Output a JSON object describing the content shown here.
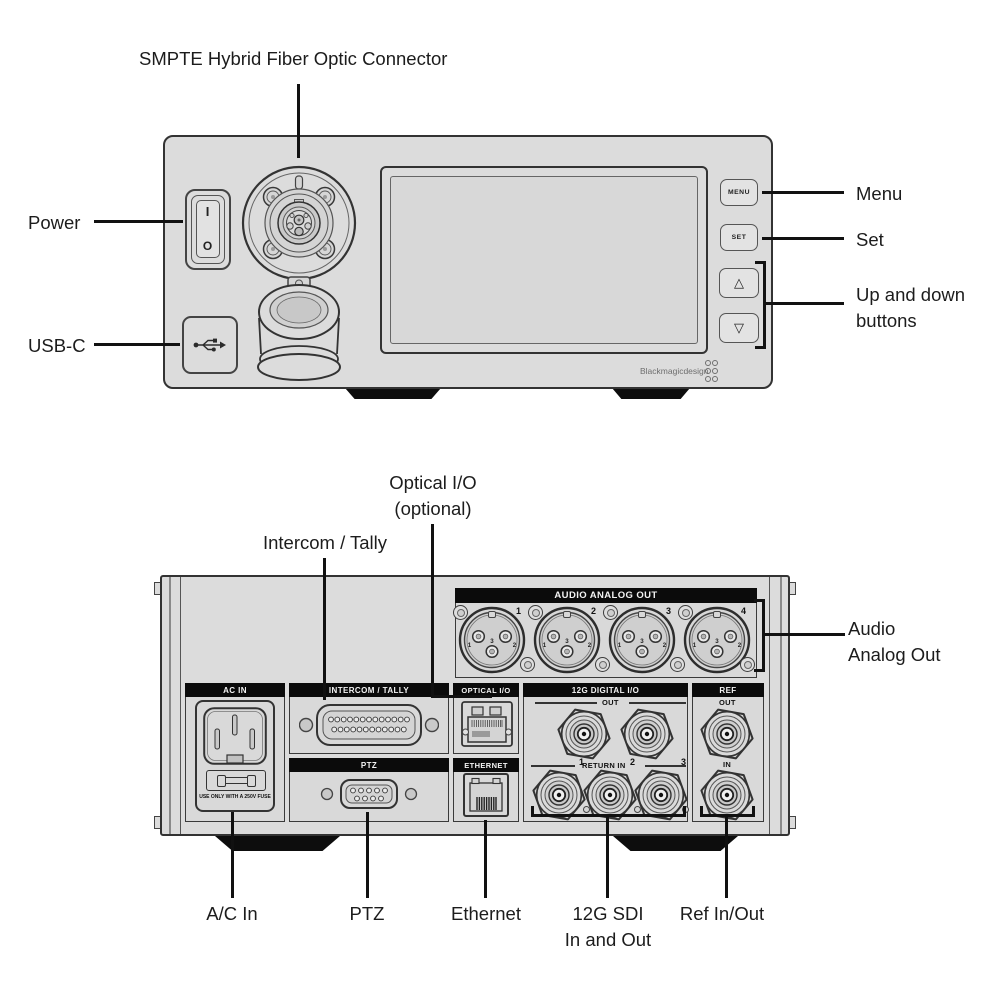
{
  "front": {
    "callout_smpte": "SMPTE Hybrid Fiber Optic Connector",
    "callout_power": "Power",
    "callout_usbc": "USB-C",
    "callout_menu": "Menu",
    "callout_set": "Set",
    "callout_updown": [
      "Up and down",
      "buttons"
    ],
    "btn_menu": "MENU",
    "btn_set": "SET",
    "btn_up": "△",
    "btn_down": "▽",
    "power_on": "I",
    "power_off": "O",
    "brand": "Blackmagicdesign"
  },
  "rear": {
    "callout_optical": [
      "Optical I/O",
      "(optional)"
    ],
    "callout_intercom": "Intercom / Tally",
    "callout_audio": [
      "Audio",
      "Analog Out"
    ],
    "callout_acin": "A/C In",
    "callout_ptz": "PTZ",
    "callout_ethernet": "Ethernet",
    "callout_sdi": [
      "12G SDI",
      "In and Out"
    ],
    "callout_ref": "Ref In/Out",
    "audio_header": "AUDIO ANALOG OUT",
    "xlr_numbers": [
      "1",
      "2",
      "3",
      "4"
    ],
    "pin_labels": [
      "1",
      "3",
      "2"
    ],
    "headers": {
      "acin": "AC IN",
      "intercom": "INTERCOM / TALLY",
      "optical": "OPTICAL I/O",
      "digital": "12G DIGITAL I/O",
      "ref": "REF",
      "ptz": "PTZ",
      "ethernet": "ETHERNET"
    },
    "fuse_note": "USE ONLY WITH A 250V FUSE",
    "digital_out_label": "OUT",
    "digital_return_label": "RETURN IN",
    "return_numbers": [
      "1",
      "2",
      "3"
    ],
    "ref_out_label": "OUT",
    "ref_in_label": "IN"
  },
  "colors": {
    "panel": "#dcdcdc",
    "callout_line": "#111111",
    "header_bg": "#0b0b0b",
    "header_text": "#f4f4f4"
  }
}
